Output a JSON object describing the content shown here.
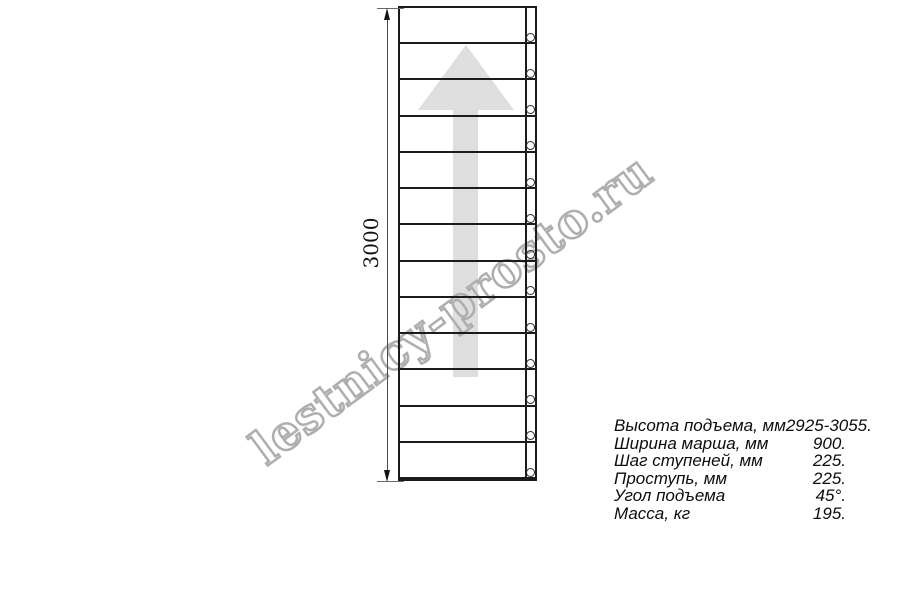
{
  "drawing": {
    "dimension_label": "3000",
    "steps_count": 13,
    "colors": {
      "line": "#1b1b1b",
      "arrow": "#dedede",
      "watermark": "#aeaeae"
    }
  },
  "watermark": {
    "text": "lestnicy-prosto.ru"
  },
  "specs": {
    "rows": [
      {
        "label": "Высота подъема, мм",
        "value": "2925-3055."
      },
      {
        "label": "Ширина марша, мм",
        "value": "900."
      },
      {
        "label": "Шаг ступеней, мм",
        "value": "225."
      },
      {
        "label": "Проступь, мм",
        "value": "225."
      },
      {
        "label": "Угол подъема",
        "value": "45°."
      },
      {
        "label": "Масса, кг",
        "value": "195."
      }
    ]
  }
}
